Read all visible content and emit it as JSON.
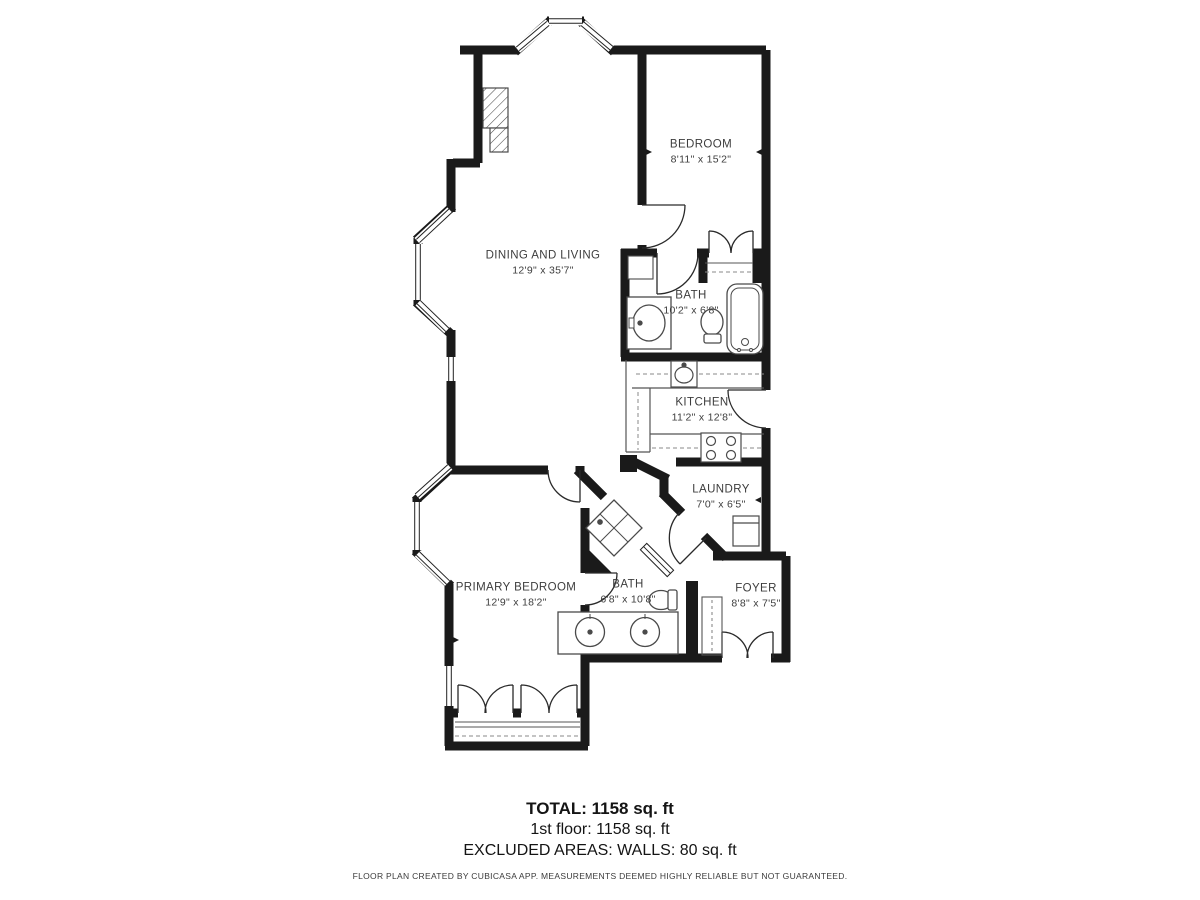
{
  "rooms": [
    {
      "name": "BEDROOM",
      "dims": "8'11\" x 15'2\""
    },
    {
      "name": "DINING AND LIVING",
      "dims": "12'9\" x 35'7\""
    },
    {
      "name": "BATH",
      "dims": "10'2\" x 6'8\""
    },
    {
      "name": "KITCHEN",
      "dims": "11'2\" x 12'8\""
    },
    {
      "name": "LAUNDRY",
      "dims": "7'0\" x 6'5\""
    },
    {
      "name": "PRIMARY BEDROOM",
      "dims": "12'9\" x 18'2\""
    },
    {
      "name": "BATH",
      "dims": "6'8\" x 10'8\""
    },
    {
      "name": "FOYER",
      "dims": "8'8\" x 7'5\""
    }
  ],
  "summary": {
    "total": "TOTAL: 1158 sq. ft",
    "floor1": "1st floor: 1158 sq. ft",
    "excluded": "EXCLUDED AREAS: WALLS: 80 sq. ft"
  },
  "footer": "FLOOR PLAN CREATED BY CUBICASA APP. MEASUREMENTS DEEMED HIGHLY RELIABLE BUT NOT GUARANTEED.",
  "colors": {
    "wall": "#1a1a1a",
    "label_text": "#3d3d3d",
    "summary_text": "#141414",
    "fixture_stroke": "#4a4a4a"
  }
}
